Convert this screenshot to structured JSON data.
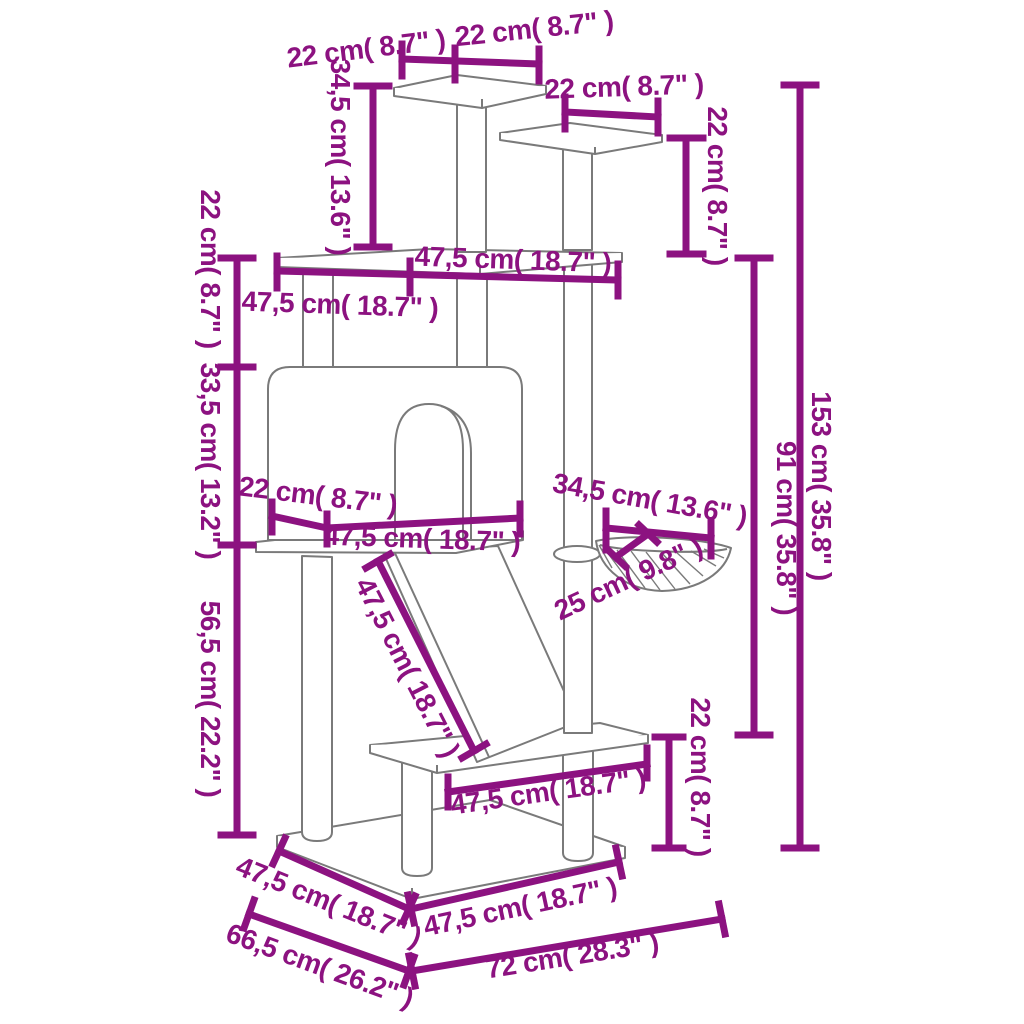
{
  "figure": {
    "kind": "dimension-diagram",
    "units_visible": [
      "cm",
      "inches"
    ]
  },
  "colors": {
    "dimension_color": "#8C1280",
    "drawing_color": "#7a7a7a",
    "background": "#ffffff"
  },
  "dimensions": [
    {
      "name": "top-platform-depth-22",
      "text": "22 cm( 8.7\" )",
      "label": {
        "x": 366,
        "y": 48,
        "rot": -7
      },
      "lines": [
        [
          402,
          59,
          539,
          64
        ],
        [
          402,
          44,
          402,
          76
        ],
        [
          455,
          48,
          455,
          80
        ],
        [
          539,
          49,
          539,
          81
        ]
      ]
    },
    {
      "name": "top-platform-width-22",
      "text": "22 cm( 8.7\" )",
      "label": {
        "x": 534,
        "y": 28,
        "rot": -6
      },
      "lines": []
    },
    {
      "name": "second-platform-width-22",
      "text": "22 cm( 8.7\" )",
      "label": {
        "x": 624,
        "y": 86,
        "rot": -2
      },
      "lines": [
        [
          565,
          112,
          658,
          117
        ],
        [
          565,
          97,
          565,
          129
        ],
        [
          658,
          101,
          658,
          133
        ]
      ]
    },
    {
      "name": "second-platform-height-22",
      "text": "22 cm( 8.7\" )",
      "label": {
        "x": 718,
        "y": 186,
        "rot": 90
      },
      "lines": [
        [
          686,
          138,
          686,
          254
        ],
        [
          670,
          138,
          703,
          138
        ],
        [
          670,
          254,
          703,
          254
        ]
      ]
    },
    {
      "name": "top-post-height-34-5",
      "text": "34,5 cm( 13.6\" )",
      "label": {
        "x": 341,
        "y": 157,
        "rot": 90
      },
      "lines": [
        [
          373,
          86,
          373,
          247
        ],
        [
          357,
          86,
          389,
          86
        ],
        [
          357,
          247,
          389,
          247
        ]
      ]
    },
    {
      "name": "main-platform-width-47-5",
      "text": "47,5 cm( 18.7\" )",
      "label": {
        "x": 513,
        "y": 259,
        "rot": 2
      },
      "lines": [
        [
          277,
          271,
          618,
          280
        ],
        [
          277,
          256,
          277,
          288
        ],
        [
          410,
          261,
          410,
          293
        ],
        [
          618,
          264,
          618,
          296
        ]
      ]
    },
    {
      "name": "main-platform-depth-47-5",
      "text": "47,5 cm( 18.7\" )",
      "label": {
        "x": 340,
        "y": 304,
        "rot": 2
      },
      "lines": []
    },
    {
      "name": "platform-to-house-height-22",
      "text": "22 cm( 8.7\" )",
      "label": {
        "x": 211,
        "y": 269,
        "rot": 90
      },
      "lines": [
        [
          237,
          258,
          237,
          835
        ],
        [
          221,
          258,
          253,
          258
        ],
        [
          221,
          367,
          253,
          367
        ],
        [
          221,
          545,
          253,
          545
        ],
        [
          221,
          835,
          253,
          835
        ]
      ]
    },
    {
      "name": "house-height-33-5",
      "text": "33,5 cm( 13.2\" )",
      "label": {
        "x": 211,
        "y": 461,
        "rot": 90
      },
      "lines": []
    },
    {
      "name": "house-to-base-height-56-5",
      "text": "56,5 cm( 22.2\" )",
      "label": {
        "x": 211,
        "y": 699,
        "rot": 90
      },
      "lines": []
    },
    {
      "name": "house-depth-22",
      "text": "22 cm( 8.7\" )",
      "label": {
        "x": 318,
        "y": 495,
        "rot": 7
      },
      "lines": [
        [
          272,
          516,
          327,
          528
        ],
        [
          327,
          528,
          520,
          518
        ],
        [
          272,
          502,
          272,
          532
        ],
        [
          327,
          514,
          327,
          544
        ],
        [
          520,
          504,
          520,
          534
        ]
      ]
    },
    {
      "name": "house-width-47-5",
      "text": "47,5 cm( 18.7\" )",
      "label": {
        "x": 422,
        "y": 538,
        "rot": 2
      },
      "lines": []
    },
    {
      "name": "ramp-length-47-5",
      "text": "47,5 cm( 18.7\" )",
      "label": {
        "x": 408,
        "y": 667,
        "rot": 63
      },
      "lines": [
        [
          378,
          561,
          474,
          751
        ],
        [
          390,
          554,
          366,
          568
        ],
        [
          486,
          744,
          462,
          758
        ]
      ]
    },
    {
      "name": "basket-width-34-5",
      "text": "34,5 cm( 13.6\" )",
      "label": {
        "x": 650,
        "y": 499,
        "rot": 10
      },
      "lines": [
        [
          606,
          528,
          711,
          538
        ],
        [
          606,
          511,
          606,
          550
        ],
        [
          711,
          521,
          711,
          556
        ]
      ]
    },
    {
      "name": "basket-depth-25",
      "text": "25 cm( 9.8\" )",
      "label": {
        "x": 628,
        "y": 578,
        "rot": -25
      },
      "lines": [
        [
          648,
          534,
          616,
          557
        ],
        [
          639,
          525,
          657,
          542
        ],
        [
          607,
          549,
          625,
          566
        ]
      ]
    },
    {
      "name": "lower-platform-width-47-5",
      "text": "47,5 cm( 18.7\" )",
      "label": {
        "x": 548,
        "y": 791,
        "rot": -8
      },
      "lines": [
        [
          448,
          792,
          647,
          764
        ],
        [
          448,
          777,
          448,
          807
        ],
        [
          647,
          748,
          647,
          778
        ]
      ]
    },
    {
      "name": "lower-platform-height-22",
      "text": "22 cm( 8.7\" )",
      "label": {
        "x": 701,
        "y": 777,
        "rot": 90
      },
      "lines": [
        [
          669,
          737,
          669,
          848
        ],
        [
          655,
          737,
          683,
          737
        ],
        [
          655,
          848,
          683,
          848
        ]
      ]
    },
    {
      "name": "upper-section-height-91",
      "text": "91 cm( 35.8\" )",
      "label": {
        "x": 787,
        "y": 528,
        "rot": 90
      },
      "lines": [
        [
          754,
          258,
          754,
          735
        ],
        [
          738,
          258,
          770,
          258
        ],
        [
          738,
          735,
          770,
          735
        ]
      ]
    },
    {
      "name": "total-height-153",
      "text": "153 cm( 35.8\" )",
      "label": {
        "x": 822,
        "y": 486,
        "rot": 90
      },
      "lines": [
        [
          800,
          85,
          800,
          848
        ],
        [
          784,
          85,
          816,
          85
        ],
        [
          784,
          848,
          816,
          848
        ]
      ]
    },
    {
      "name": "base-top-left-47-5",
      "text": "47,5 cm( 18.7\" )",
      "label": {
        "x": 329,
        "y": 901,
        "rot": 22
      },
      "lines": [
        [
          279,
          851,
          409,
          909
        ],
        [
          273,
          864,
          285,
          838
        ],
        [
          403,
          922,
          415,
          896
        ]
      ]
    },
    {
      "name": "base-top-right-47-5",
      "text": "47,5 cm( 18.7\" )",
      "label": {
        "x": 520,
        "y": 906,
        "rot": -12
      },
      "lines": [
        [
          411,
          909,
          619,
          862
        ],
        [
          414,
          923,
          408,
          895
        ],
        [
          622,
          876,
          616,
          848
        ]
      ]
    },
    {
      "name": "base-depth-66-5",
      "text": "66,5 cm( 26.2\" )",
      "label": {
        "x": 320,
        "y": 965,
        "rot": 20
      },
      "lines": [
        [
          249,
          914,
          409,
          971
        ],
        [
          244,
          928,
          254,
          900
        ],
        [
          404,
          985,
          414,
          957
        ]
      ]
    },
    {
      "name": "base-width-72",
      "text": "72 cm( 28.3\" )",
      "label": {
        "x": 572,
        "y": 955,
        "rot": -9
      },
      "lines": [
        [
          412,
          971,
          722,
          919
        ],
        [
          415,
          986,
          409,
          956
        ],
        [
          725,
          934,
          719,
          904
        ]
      ]
    }
  ]
}
